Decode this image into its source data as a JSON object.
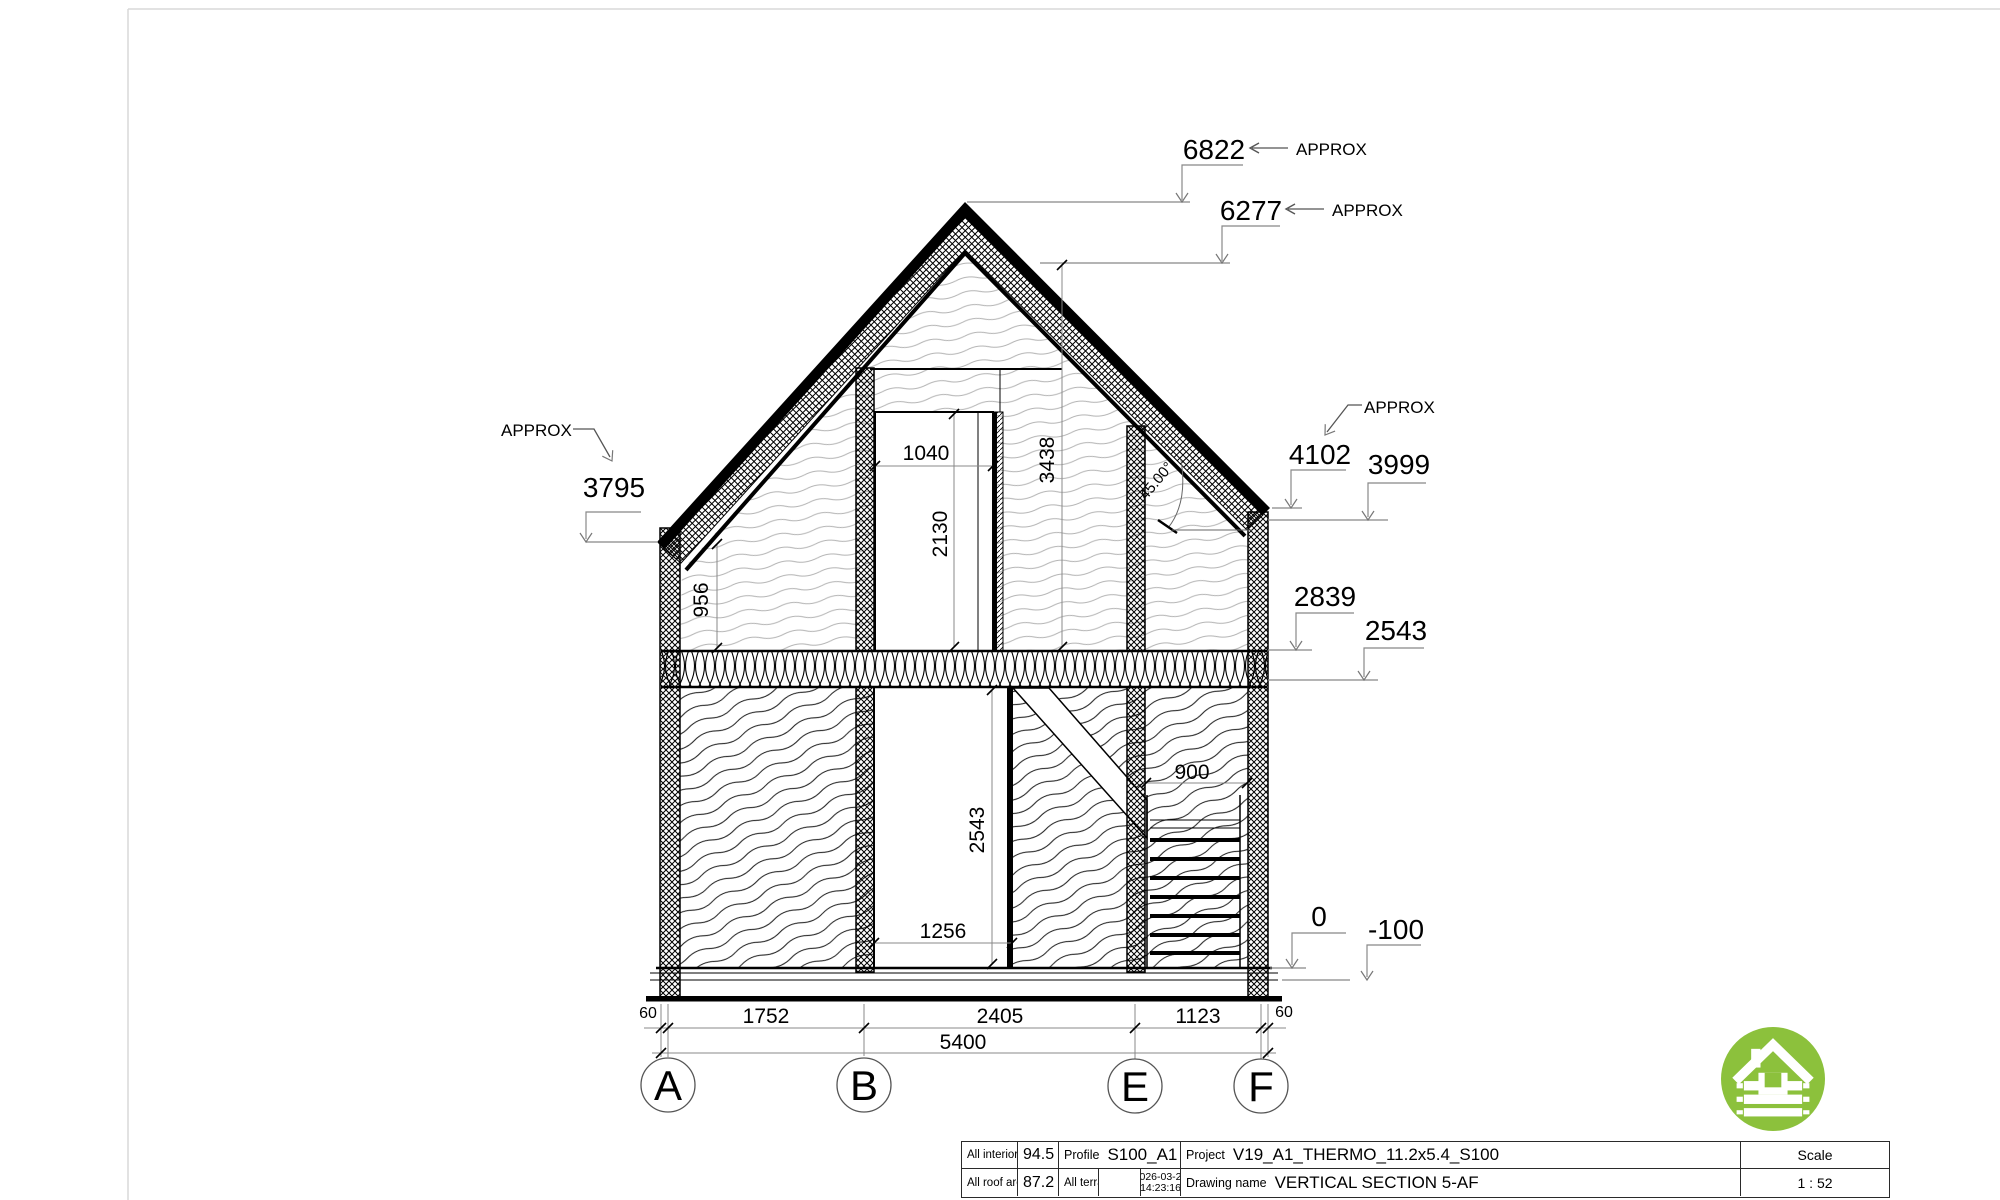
{
  "labels": {
    "approx": "APPROX",
    "angle": "45.00°",
    "lvl6822": "6822",
    "lvl6277": "6277",
    "lvl3795": "3795",
    "lvl4102": "4102",
    "lvl3999": "3999",
    "lvl2839": "2839",
    "lvl2543": "2543",
    "lvl0": "0",
    "lvlm100": "-100",
    "d1040": "1040",
    "d2130": "2130",
    "d3438": "3438",
    "d956": "956",
    "d900": "900",
    "d2543v": "2543",
    "d1256": "1256",
    "d60l": "60",
    "d1752": "1752",
    "d2405": "2405",
    "d1123": "1123",
    "d60r": "60",
    "d5400": "5400",
    "axA": "A",
    "axB": "B",
    "axE": "E",
    "axF": "F"
  },
  "title_block": {
    "interior_label": "All interior area",
    "interior_value": "94.5 m2",
    "profile_label": "Profile",
    "profile_value": "S100_A1",
    "project_label": "Project",
    "project_value": "V19_A1_THERMO_11.2x5.4_S100",
    "scale_label": "Scale",
    "scale_value": "1 : 52",
    "roof_label": "All roof area",
    "roof_value": "87.2 m2",
    "terrace_label": "All terrace",
    "date": "2026-03-20",
    "time": "14:23:16",
    "drawing_label": "Drawing name",
    "drawing_value": "VERTICAL SECTION 5-AF"
  },
  "logo": {
    "color": "#8cc13c"
  }
}
